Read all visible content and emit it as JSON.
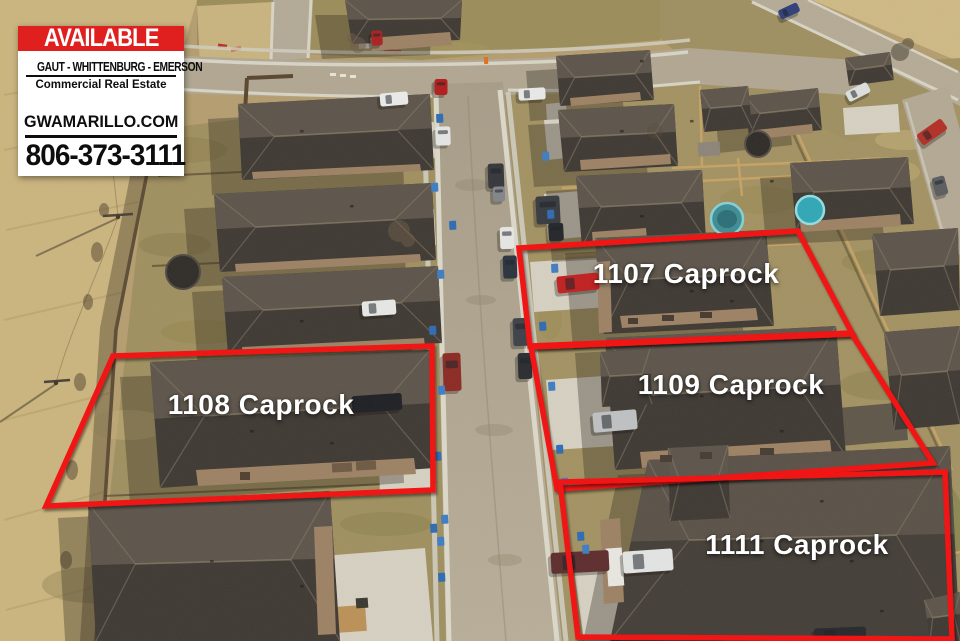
{
  "sign": {
    "banner": "AVAILABLE",
    "banner_bg": "#e0201e",
    "banner_text_color": "#ffffff",
    "company": "GAUT - WHITTENBURG - EMERSON",
    "tagline": "Commercial Real Estate",
    "website": "GWAMARILLO.COM",
    "phone": "806-373-3111",
    "text_color": "#0d0d0d",
    "bg": "#ffffff"
  },
  "annotation": {
    "stroke_color": "#f11212",
    "stroke_width": 5.5,
    "label_color": "#ffffff",
    "lots": [
      {
        "name": "lot-1107",
        "label": "1107 Caprock",
        "polygon": [
          [
            519,
            248
          ],
          [
            798,
            231
          ],
          [
            852,
            333
          ],
          [
            530,
            346
          ]
        ],
        "label_pos": [
          686,
          274
        ],
        "font_size": 28
      },
      {
        "name": "lot-1109",
        "label": "1109 Caprock",
        "polygon": [
          [
            531,
            347
          ],
          [
            852,
            334
          ],
          [
            933,
            463
          ],
          [
            557,
            489
          ]
        ],
        "label_pos": [
          731,
          385
        ],
        "font_size": 28
      },
      {
        "name": "lot-1108",
        "label": "1108 Caprock",
        "polygon": [
          [
            113,
            356
          ],
          [
            432,
            346
          ],
          [
            433,
            490
          ],
          [
            46,
            506
          ]
        ],
        "label_pos": [
          261,
          405
        ],
        "font_size": 28
      },
      {
        "name": "lot-1111",
        "label": "1111 Caprock",
        "polygon": [
          [
            560,
            482
          ],
          [
            945,
            472
          ],
          [
            952,
            639
          ],
          [
            578,
            637
          ]
        ],
        "label_pos": [
          797,
          545
        ],
        "font_size": 28
      }
    ]
  }
}
